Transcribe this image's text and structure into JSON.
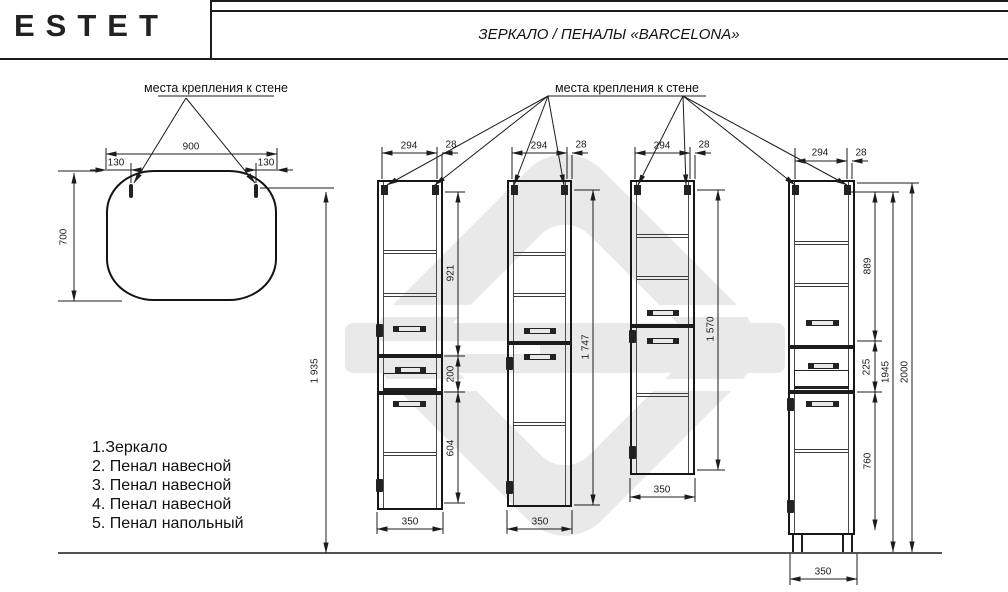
{
  "header": {
    "logo": "ESTET",
    "title": "ЗЕРКАЛО / ПЕНАЛЫ «BARCELONA»"
  },
  "annotations": {
    "mirror_mount_label": "места крепления к стене",
    "cabinet_mount_label": "места крепления к стене"
  },
  "legend": [
    "1.Зеркало",
    "2. Пенал навесной",
    "3. Пенал навесной",
    "4. Пенал навесной",
    "5. Пенал напольный"
  ],
  "dims": {
    "mirror": {
      "width": "900",
      "left_offset": "130",
      "right_offset": "130",
      "height": "700",
      "mount_height": "1 935"
    },
    "cab1": {
      "door_width": "294",
      "overhang": "28",
      "upper": "921",
      "drawer": "200",
      "lower": "604",
      "width": "350"
    },
    "cab2": {
      "door_width": "294",
      "overhang": "28",
      "height": "1 747",
      "width": "350"
    },
    "cab3": {
      "door_width": "294",
      "overhang": "28",
      "height": "1 570",
      "width": "350"
    },
    "cab4": {
      "door_width": "294",
      "overhang": "28",
      "upper": "889",
      "drawer": "225",
      "lower": "760",
      "body_height": "1945",
      "total_height": "2000",
      "width": "350"
    }
  }
}
